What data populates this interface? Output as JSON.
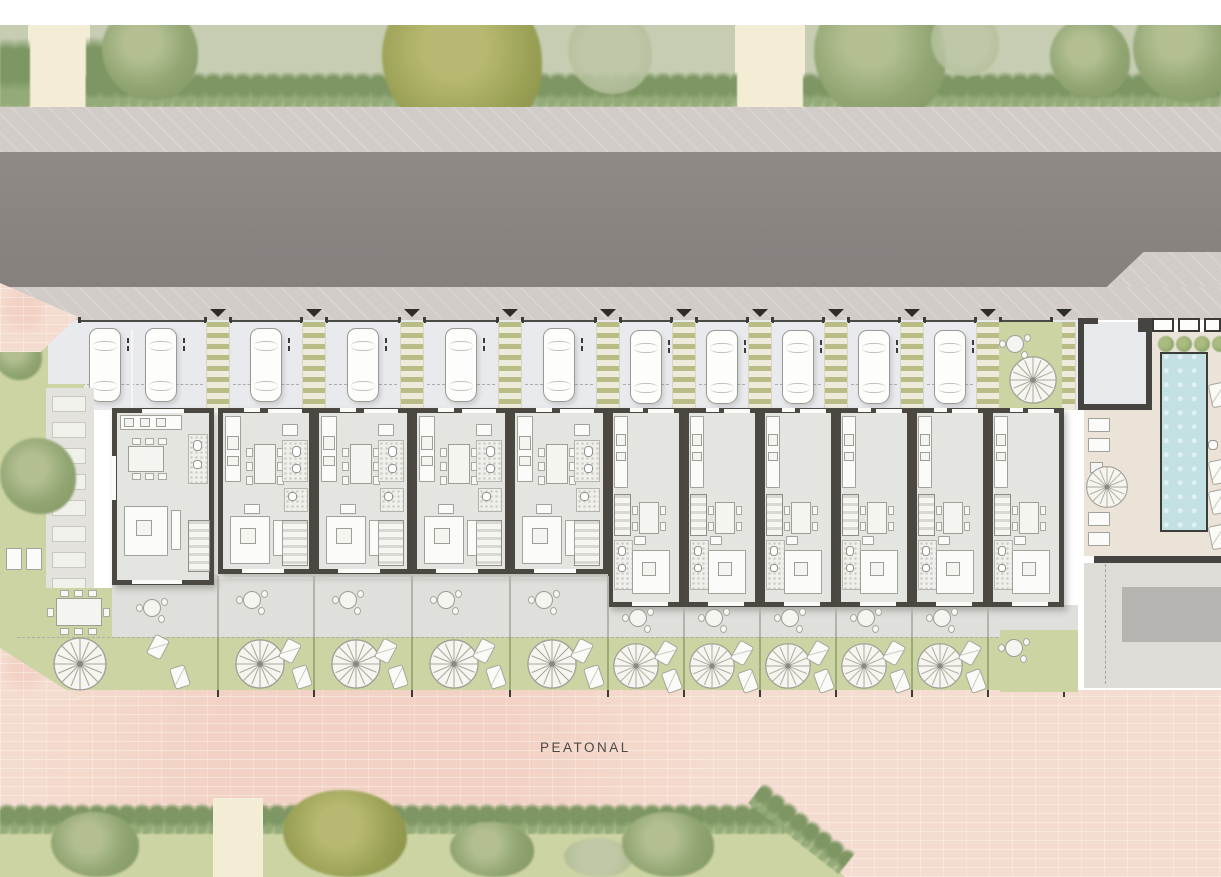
{
  "labels": {
    "peatonal": "PEATONAL"
  },
  "palette": {
    "park_green": "#c6cdb3",
    "hedge_green": "#7d9663",
    "lawn_green": "#cdd4a3",
    "path_beige": "#f4edd6",
    "sidewalk_gray": "#d2ccc9",
    "road_gray": "#8b8582",
    "parking_gray": "#e9eaed",
    "wall_dark": "#4b4741",
    "floor_gray": "#e4e4e0",
    "terrace_gray": "#dfdfdc",
    "deck_cream": "#ebe3d8",
    "pool_blue": "#c3e0e2",
    "plaza_pink": "#f5dcd0",
    "walkway_green": "#b9bd85",
    "furniture_white": "#fbfbf9"
  },
  "layout": {
    "canvas": {
      "w": 1221,
      "h": 877
    },
    "bands": {
      "white_top": [
        0,
        25
      ],
      "park": [
        25,
        107
      ],
      "sidewalk_top": [
        107,
        152
      ],
      "road": [
        152,
        290
      ],
      "sidewalk_low": [
        287,
        320
      ],
      "parking": [
        320,
        410
      ],
      "buildings": [
        408,
        607
      ],
      "terrace": [
        574,
        637
      ],
      "gardens": [
        637,
        697
      ],
      "plaza": [
        690,
        877
      ],
      "bottom_garden": [
        800,
        877
      ]
    },
    "park_paths": [
      {
        "x": 28,
        "w": 62
      },
      {
        "x": 735,
        "w": 70
      }
    ],
    "trees_top": [
      {
        "cx": 150,
        "cy": 52,
        "r": 48,
        "k": "g"
      },
      {
        "cx": 462,
        "cy": 60,
        "r": 80,
        "k": "o"
      },
      {
        "cx": 610,
        "cy": 52,
        "r": 42,
        "k": "p"
      },
      {
        "cx": 880,
        "cy": 55,
        "r": 66,
        "k": "g"
      },
      {
        "cx": 965,
        "cy": 42,
        "r": 34,
        "k": "p"
      },
      {
        "cx": 1090,
        "cy": 58,
        "r": 40,
        "k": "g"
      },
      {
        "cx": 1185,
        "cy": 50,
        "r": 52,
        "k": "g"
      }
    ],
    "left_trees": [
      {
        "cx": 18,
        "cy": 356,
        "r": 24,
        "k": "g"
      },
      {
        "cx": 38,
        "cy": 476,
        "r": 38,
        "k": "g"
      }
    ],
    "trees_bottom": [
      {
        "cx": 95,
        "cy": 856,
        "r": 44,
        "k": "g"
      },
      {
        "cx": 345,
        "cy": 852,
        "r": 62,
        "k": "o"
      },
      {
        "cx": 492,
        "cy": 864,
        "r": 42,
        "k": "g"
      },
      {
        "cx": 598,
        "cy": 872,
        "r": 34,
        "k": "p"
      },
      {
        "cx": 668,
        "cy": 858,
        "r": 46,
        "k": "g"
      }
    ],
    "bottom_garden": {
      "x": 0,
      "y": 810,
      "w": 845,
      "chamfer": 70,
      "path_gap": {
        "x": 213,
        "w": 50
      }
    },
    "boundaries": [
      218,
      314,
      412,
      510,
      608,
      684,
      760,
      836,
      912,
      988,
      1064
    ],
    "walkway": {
      "width": 24,
      "top": 322,
      "bottom": 410
    },
    "units": [
      {
        "id": "corner",
        "type": "corner",
        "x": 112,
        "w": 102
      },
      {
        "id": "A1",
        "type": "wide",
        "x": 218,
        "w": 96
      },
      {
        "id": "A2",
        "type": "wide",
        "x": 314,
        "w": 98
      },
      {
        "id": "A3",
        "type": "wide",
        "x": 412,
        "w": 98
      },
      {
        "id": "A4",
        "type": "wide",
        "x": 510,
        "w": 98
      },
      {
        "id": "B1",
        "type": "narrow",
        "x": 608,
        "w": 76
      },
      {
        "id": "B2",
        "type": "narrow",
        "x": 684,
        "w": 76
      },
      {
        "id": "B3",
        "type": "narrow",
        "x": 760,
        "w": 76
      },
      {
        "id": "B4",
        "type": "narrow",
        "x": 836,
        "w": 76
      },
      {
        "id": "B5",
        "type": "narrow",
        "x": 912,
        "w": 76
      },
      {
        "id": "B6",
        "type": "narrow",
        "x": 988,
        "w": 76
      }
    ],
    "wide_building": {
      "top": 408,
      "h": 166
    },
    "narrow_building": {
      "top": 408,
      "h": 199
    },
    "corner_building": {
      "top": 408,
      "h": 177
    },
    "cars": [
      {
        "cx": 105,
        "y": 328
      },
      {
        "cx": 161,
        "y": 328
      },
      {
        "cx": 266,
        "y": 328
      },
      {
        "cx": 363,
        "y": 328
      },
      {
        "cx": 461,
        "y": 328
      },
      {
        "cx": 559,
        "y": 328
      },
      {
        "cx": 646,
        "y": 330
      },
      {
        "cx": 722,
        "y": 330
      },
      {
        "cx": 798,
        "y": 330
      },
      {
        "cx": 874,
        "y": 330
      },
      {
        "cx": 950,
        "y": 330
      },
      {
        "cx": 1115,
        "y": 330
      }
    ],
    "bays": [
      [
        78,
        207
      ],
      [
        229,
        303
      ],
      [
        325,
        401
      ],
      [
        423,
        499
      ],
      [
        521,
        597
      ],
      [
        619,
        673
      ],
      [
        695,
        749
      ],
      [
        771,
        825
      ],
      [
        847,
        901
      ],
      [
        923,
        977
      ],
      [
        999,
        1053
      ]
    ],
    "front_garden_b6": {
      "x": 999,
      "y": 322,
      "w": 63,
      "h": 86
    },
    "corner_front_bed": {
      "x": 40,
      "y": 384,
      "w": 44,
      "h": 26
    },
    "stepping_path": {
      "x": 46,
      "y": 388,
      "w": 48,
      "h": 240,
      "slabs": 9
    },
    "pool_area": {
      "x": 1078,
      "wall_y": 556,
      "garage": {
        "x": 1084,
        "y": 318,
        "w": 68,
        "h": 92
      },
      "windows": [
        {
          "x": 1152,
          "w": 22
        },
        {
          "x": 1178,
          "w": 22
        },
        {
          "x": 1204,
          "w": 17
        }
      ],
      "shrubs": [
        1158,
        1176,
        1194,
        1212
      ],
      "pool": {
        "x": 1160,
        "y": 352,
        "w": 48,
        "h": 180
      },
      "loungers_left": [
        418,
        438,
        512,
        532
      ],
      "loungers_right": [
        383,
        460,
        490,
        525
      ],
      "umbrella": {
        "cx": 1107,
        "cy": 487,
        "r": 22
      },
      "gray_pad": {
        "x": 1122,
        "y": 587,
        "w": 99,
        "h": 55
      }
    },
    "road_cut": {
      "x": 1096,
      "y": 252,
      "w": 125,
      "h": 38
    },
    "peatonal_pos": {
      "x": 540,
      "y": 740
    }
  }
}
